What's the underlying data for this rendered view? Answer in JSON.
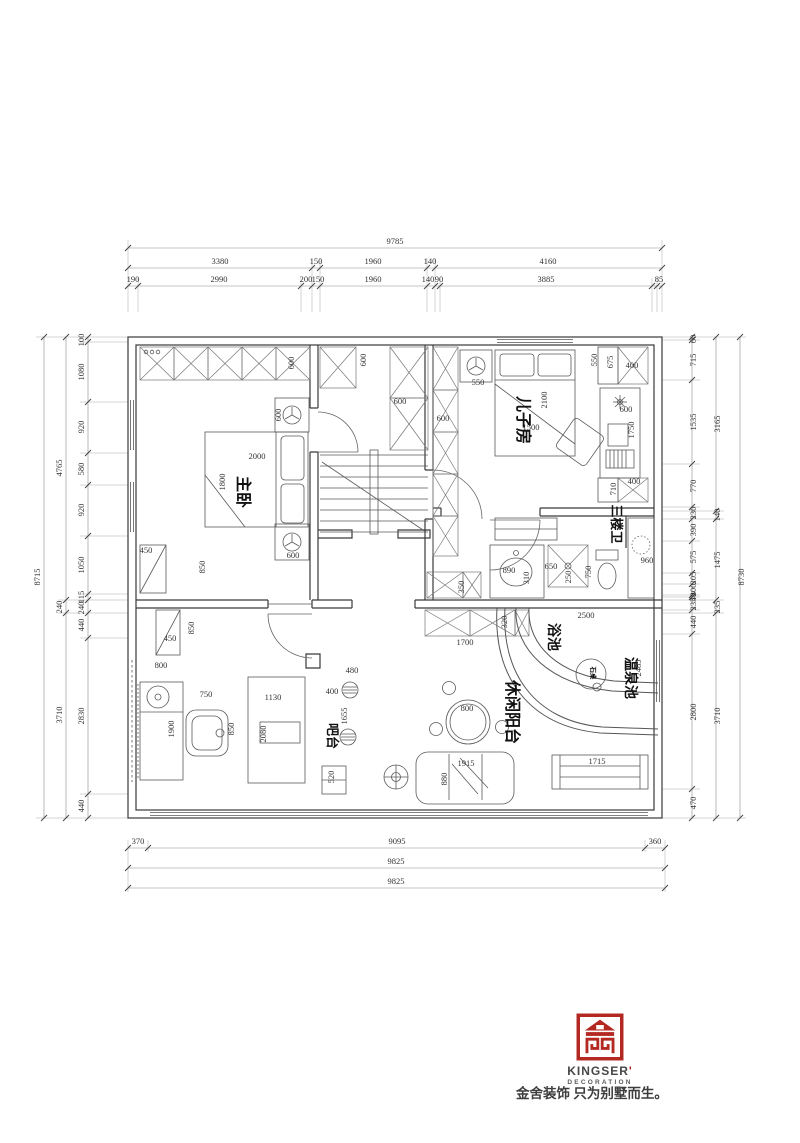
{
  "colors": {
    "accent_red": "#b32821",
    "line_dark": "#3a3a3a",
    "dim_text": "#333333"
  },
  "rooms": {
    "master": "主卧",
    "son": "儿子房",
    "bath": "三楼卫",
    "small_pool": "浴池",
    "hot_spring": "温泉池",
    "balcony": "休闲阳台",
    "bar": "吧台",
    "stone_table": "石桌"
  },
  "dim_labels": {
    "top": [
      {
        "t": "9785",
        "x": 395,
        "y": 244
      },
      {
        "t": "3380",
        "x": 220,
        "y": 264
      },
      {
        "t": "150",
        "x": 316,
        "y": 264
      },
      {
        "t": "1960",
        "x": 373,
        "y": 264
      },
      {
        "t": "140",
        "x": 430,
        "y": 264
      },
      {
        "t": "4160",
        "x": 548,
        "y": 264
      },
      {
        "t": "190",
        "x": 133,
        "y": 282
      },
      {
        "t": "2990",
        "x": 219,
        "y": 282
      },
      {
        "t": "200",
        "x": 306,
        "y": 282
      },
      {
        "t": "150",
        "x": 318,
        "y": 282
      },
      {
        "t": "1960",
        "x": 373,
        "y": 282
      },
      {
        "t": "140",
        "x": 428,
        "y": 282
      },
      {
        "t": "90",
        "x": 439,
        "y": 282
      },
      {
        "t": "3885",
        "x": 546,
        "y": 282
      },
      {
        "t": "85",
        "x": 659,
        "y": 282
      }
    ],
    "left": [
      {
        "t": "8715",
        "x": 40,
        "y": 577
      },
      {
        "t": "4765",
        "x": 62,
        "y": 468
      },
      {
        "t": "240",
        "x": 62,
        "y": 607
      },
      {
        "t": "3710",
        "x": 62,
        "y": 715
      },
      {
        "t": "100",
        "x": 84,
        "y": 340
      },
      {
        "t": "1080",
        "x": 84,
        "y": 372
      },
      {
        "t": "920",
        "x": 84,
        "y": 427
      },
      {
        "t": "580",
        "x": 84,
        "y": 469
      },
      {
        "t": "920",
        "x": 84,
        "y": 510
      },
      {
        "t": "1050",
        "x": 84,
        "y": 565
      },
      {
        "t": "115",
        "x": 84,
        "y": 597
      },
      {
        "t": "240",
        "x": 84,
        "y": 608
      },
      {
        "t": "440",
        "x": 84,
        "y": 625
      },
      {
        "t": "2830",
        "x": 84,
        "y": 716
      },
      {
        "t": "440",
        "x": 84,
        "y": 806
      }
    ],
    "right": [
      {
        "t": "60",
        "x": 696,
        "y": 339
      },
      {
        "t": "715",
        "x": 696,
        "y": 360
      },
      {
        "t": "1535",
        "x": 696,
        "y": 422
      },
      {
        "t": "770",
        "x": 696,
        "y": 486
      },
      {
        "t": "230",
        "x": 696,
        "y": 513
      },
      {
        "t": "390",
        "x": 696,
        "y": 530
      },
      {
        "t": "575",
        "x": 696,
        "y": 557
      },
      {
        "t": "205",
        "x": 696,
        "y": 578
      },
      {
        "t": "200",
        "x": 696,
        "y": 590
      },
      {
        "t": "40",
        "x": 696,
        "y": 597
      },
      {
        "t": "235",
        "x": 696,
        "y": 604
      },
      {
        "t": "440",
        "x": 696,
        "y": 622
      },
      {
        "t": "2800",
        "x": 696,
        "y": 712
      },
      {
        "t": "470",
        "x": 696,
        "y": 803
      },
      {
        "t": "3165",
        "x": 720,
        "y": 424
      },
      {
        "t": "140",
        "x": 720,
        "y": 515
      },
      {
        "t": "1475",
        "x": 720,
        "y": 560
      },
      {
        "t": "235",
        "x": 720,
        "y": 607
      },
      {
        "t": "3710",
        "x": 720,
        "y": 716
      },
      {
        "t": "8730",
        "x": 744,
        "y": 577
      }
    ],
    "bottom": [
      {
        "t": "370",
        "x": 138,
        "y": 844
      },
      {
        "t": "9095",
        "x": 397,
        "y": 844
      },
      {
        "t": "360",
        "x": 655,
        "y": 844
      },
      {
        "t": "9825",
        "x": 396,
        "y": 864
      },
      {
        "t": "9825",
        "x": 396,
        "y": 884
      }
    ],
    "interior": [
      {
        "t": "600",
        "x": 294,
        "y": 363,
        "r": -90
      },
      {
        "t": "2000",
        "x": 257,
        "y": 459,
        "r": 0
      },
      {
        "t": "1800",
        "x": 225,
        "y": 482,
        "r": -90
      },
      {
        "t": "600",
        "x": 281,
        "y": 415,
        "r": -90
      },
      {
        "t": "600",
        "x": 293,
        "y": 558,
        "r": 0
      },
      {
        "t": "450",
        "x": 146,
        "y": 553,
        "r": 0
      },
      {
        "t": "850",
        "x": 205,
        "y": 567,
        "r": -90
      },
      {
        "t": "450",
        "x": 170,
        "y": 641,
        "r": 0
      },
      {
        "t": "850",
        "x": 194,
        "y": 628,
        "r": -90
      },
      {
        "t": "800",
        "x": 161,
        "y": 668,
        "r": 0
      },
      {
        "t": "1900",
        "x": 174,
        "y": 729,
        "r": -90
      },
      {
        "t": "750",
        "x": 206,
        "y": 697,
        "r": 0
      },
      {
        "t": "850",
        "x": 234,
        "y": 729,
        "r": -90
      },
      {
        "t": "1130",
        "x": 273,
        "y": 700,
        "r": 0
      },
      {
        "t": "2080",
        "x": 266,
        "y": 734,
        "r": -90
      },
      {
        "t": "400",
        "x": 332,
        "y": 694,
        "r": 0
      },
      {
        "t": "480",
        "x": 352,
        "y": 673,
        "r": 0
      },
      {
        "t": "1655",
        "x": 347,
        "y": 716,
        "r": -90
      },
      {
        "t": "520",
        "x": 334,
        "y": 777,
        "r": -90
      },
      {
        "t": "600",
        "x": 366,
        "y": 360,
        "r": -90
      },
      {
        "t": "600",
        "x": 400,
        "y": 404,
        "r": 0
      },
      {
        "t": "600",
        "x": 443,
        "y": 421,
        "r": 0
      },
      {
        "t": "550",
        "x": 478,
        "y": 385,
        "r": 0
      },
      {
        "t": "2100",
        "x": 547,
        "y": 400,
        "r": -90
      },
      {
        "t": "1500",
        "x": 531,
        "y": 430,
        "r": 0
      },
      {
        "t": "550",
        "x": 597,
        "y": 360,
        "r": -90
      },
      {
        "t": "675",
        "x": 613,
        "y": 362,
        "r": -90
      },
      {
        "t": "400",
        "x": 632,
        "y": 368,
        "r": 0
      },
      {
        "t": "600",
        "x": 626,
        "y": 412,
        "r": 0
      },
      {
        "t": "1750",
        "x": 634,
        "y": 430,
        "r": -90
      },
      {
        "t": "400",
        "x": 634,
        "y": 484,
        "r": 0
      },
      {
        "t": "710",
        "x": 616,
        "y": 489,
        "r": -90
      },
      {
        "t": "890",
        "x": 509,
        "y": 573,
        "r": 0
      },
      {
        "t": "310",
        "x": 529,
        "y": 578,
        "r": -90
      },
      {
        "t": "650",
        "x": 551,
        "y": 569,
        "r": 0
      },
      {
        "t": "250",
        "x": 571,
        "y": 577,
        "r": -90
      },
      {
        "t": "750",
        "x": 591,
        "y": 572,
        "r": -90
      },
      {
        "t": "350",
        "x": 464,
        "y": 587,
        "r": -90
      },
      {
        "t": "960",
        "x": 647,
        "y": 563,
        "r": 0
      },
      {
        "t": "320",
        "x": 507,
        "y": 622,
        "r": -90
      },
      {
        "t": "1700",
        "x": 465,
        "y": 645,
        "r": 0
      },
      {
        "t": "2500",
        "x": 586,
        "y": 618,
        "r": 0
      },
      {
        "t": "2485",
        "x": 641,
        "y": 668,
        "r": -90
      },
      {
        "t": "800",
        "x": 467,
        "y": 711,
        "r": 0
      },
      {
        "t": "1915",
        "x": 466,
        "y": 766,
        "r": 0
      },
      {
        "t": "880",
        "x": 447,
        "y": 779,
        "r": -90
      },
      {
        "t": "1715",
        "x": 597,
        "y": 764,
        "r": 0
      }
    ]
  },
  "footer": {
    "brand": "KINGSER",
    "apostrophe": "'",
    "sub": "DECORATION",
    "tagline": "金舍装饰 只为别墅而生。"
  }
}
